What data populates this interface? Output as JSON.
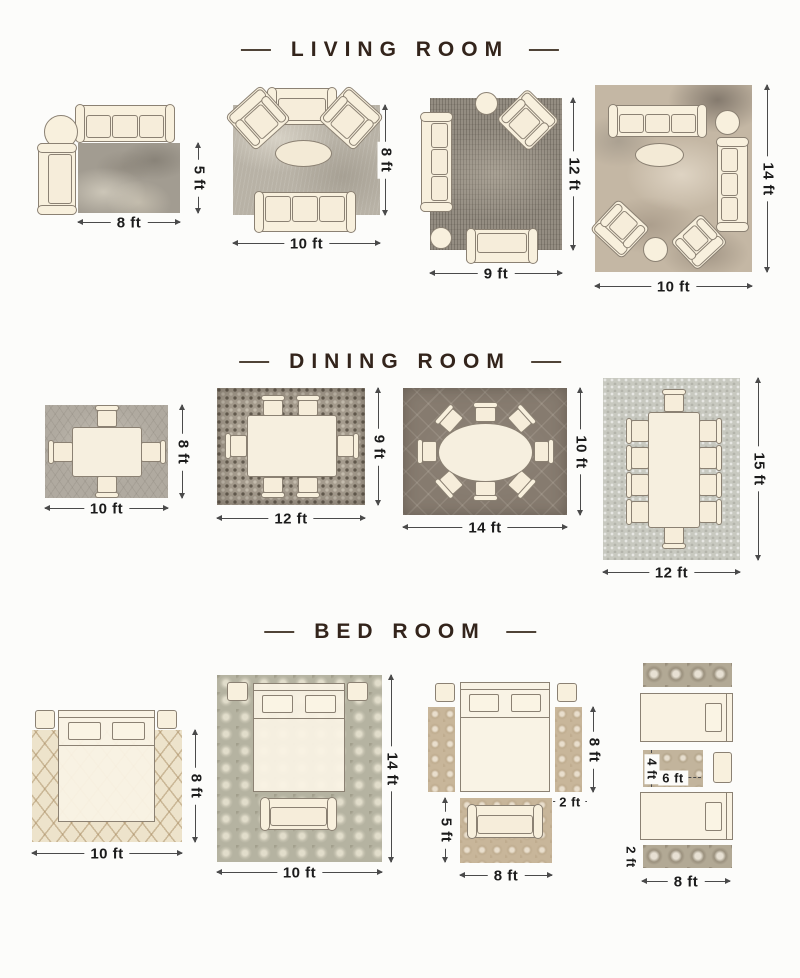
{
  "page": {
    "description": "Rug size guide infographic with room layout diagrams",
    "colors": {
      "background": "#fcfcfa",
      "title": "#33241b",
      "dimension_line": "#4a4a4a",
      "furniture_fill": "#f8f0dd",
      "furniture_outline": "#8b8173"
    }
  },
  "sections": [
    {
      "title": "LIVING ROOM",
      "layouts": [
        {
          "bottom": "8 ft",
          "side": "5 ft"
        },
        {
          "bottom": "10 ft",
          "side": "8 ft"
        },
        {
          "bottom": "9 ft",
          "side": "12 ft"
        },
        {
          "bottom": "10 ft",
          "side": "14 ft"
        }
      ]
    },
    {
      "title": "DINING ROOM",
      "layouts": [
        {
          "bottom": "10 ft",
          "side": "8 ft"
        },
        {
          "bottom": "12 ft",
          "side": "9 ft"
        },
        {
          "bottom": "14 ft",
          "side": "10 ft"
        },
        {
          "bottom": "12 ft",
          "side": "15 ft"
        }
      ]
    },
    {
      "title": "BED ROOM",
      "layouts": [
        {
          "bottom": "10 ft",
          "side": "8 ft"
        },
        {
          "bottom": "10 ft",
          "side": "14 ft"
        },
        {
          "bottom": "8 ft",
          "side": "8 ft",
          "runner_width": "2 ft",
          "foot_rug_height": "5 ft"
        },
        {
          "bottom": "8 ft",
          "runner_height": "2 ft",
          "accent_rug_width": "6 ft",
          "accent_rug_height": "4 ft"
        }
      ]
    }
  ]
}
